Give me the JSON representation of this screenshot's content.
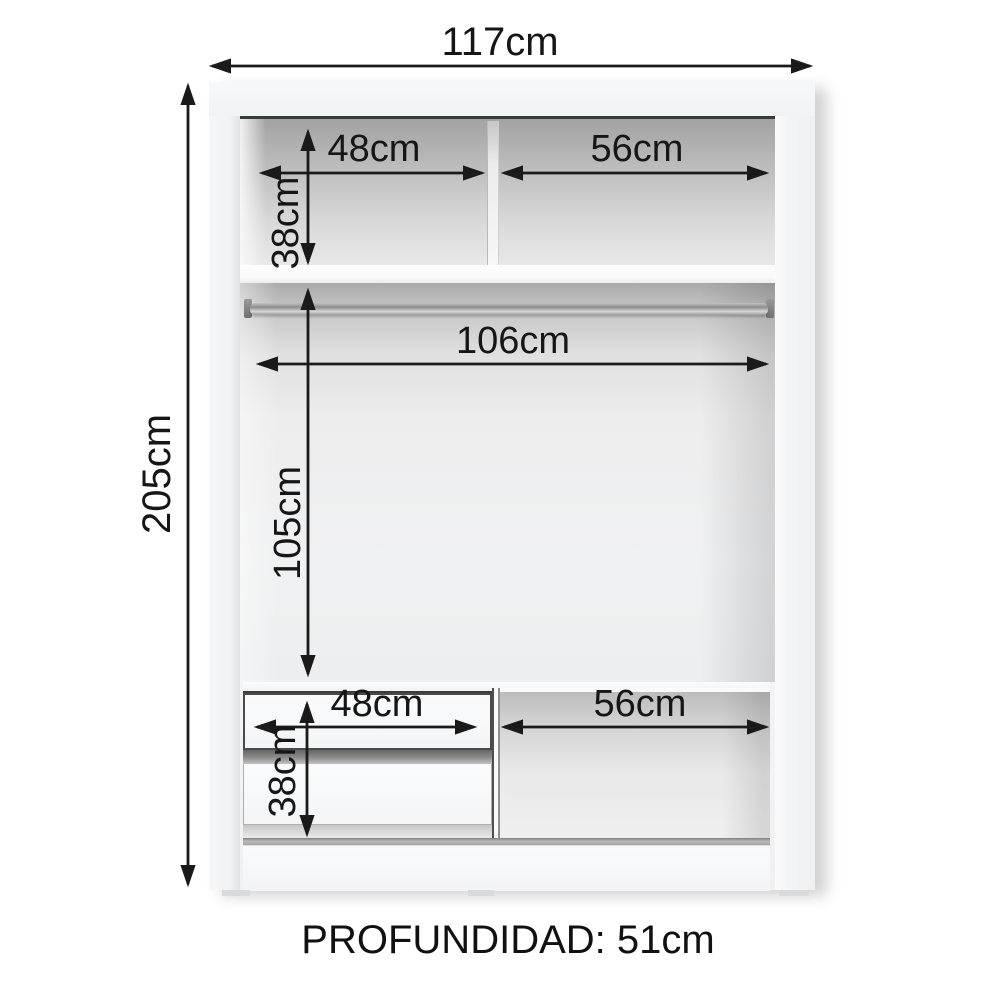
{
  "diagram": {
    "kind": "wardrobe-internal-dimensions",
    "depth_text": "PROFUNDIDAD: 51cm",
    "dims": {
      "total_width": "117cm",
      "total_height": "205cm",
      "upper_left_width": "48cm",
      "upper_right_width": "56cm",
      "upper_height": "38cm",
      "rod_width": "106cm",
      "hanging_height": "105cm",
      "drawer_width": "48cm",
      "lower_right_width": "56cm",
      "drawer_height": "38cm"
    },
    "colors": {
      "arrow_and_text": "#1a1a1a",
      "cabinet_body": "#f3f4f5",
      "interior_shadow": "#a8a8a8",
      "background": "#ffffff"
    }
  }
}
